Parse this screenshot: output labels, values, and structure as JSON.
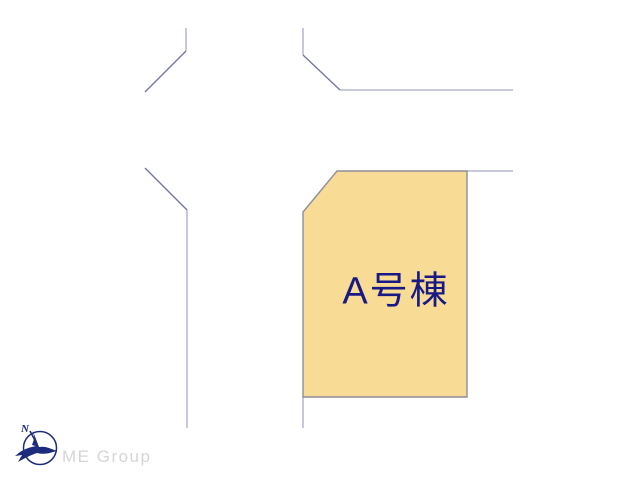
{
  "canvas": {
    "width": 640,
    "height": 480
  },
  "theme": {
    "background": "#ffffff",
    "plot_fill": "#f8db94",
    "plot_outline": "#8f8f99",
    "label_navy": "#191985",
    "road_straight": "#a9a9cb",
    "road_diagonal": "#7272a6",
    "logo_navy": "#1c2b7c",
    "logo_text_gray": "#d6d6d6"
  },
  "plot": {
    "label": "A号棟",
    "points": "337,171 467,171 467,397 303,397 303,212"
  },
  "roads": {
    "stroke_width": 1.3,
    "segments": [
      {
        "id": "north-left-vertical",
        "type": "straight",
        "points": "186,28 186,51"
      },
      {
        "id": "north-left-diagonal",
        "type": "diagonal",
        "points": "186,51 145,92"
      },
      {
        "id": "west-corner-diagonal",
        "type": "diagonal",
        "points": "145,168 187,210"
      },
      {
        "id": "west-vertical",
        "type": "straight",
        "points": "187,210 187,428"
      },
      {
        "id": "north-right-vertical",
        "type": "straight",
        "points": "303,28 303,55"
      },
      {
        "id": "north-right-diagonal",
        "type": "diagonal",
        "points": "303,55 340,90"
      },
      {
        "id": "north-horizontal",
        "type": "straight",
        "points": "340,90 513,90"
      },
      {
        "id": "east-horizontal",
        "type": "straight",
        "points": "467,171 513,171"
      },
      {
        "id": "south-vertical",
        "type": "straight",
        "points": "303,397 303,428"
      }
    ]
  },
  "logo": {
    "company": "ME Group",
    "compass_letter": "N"
  }
}
